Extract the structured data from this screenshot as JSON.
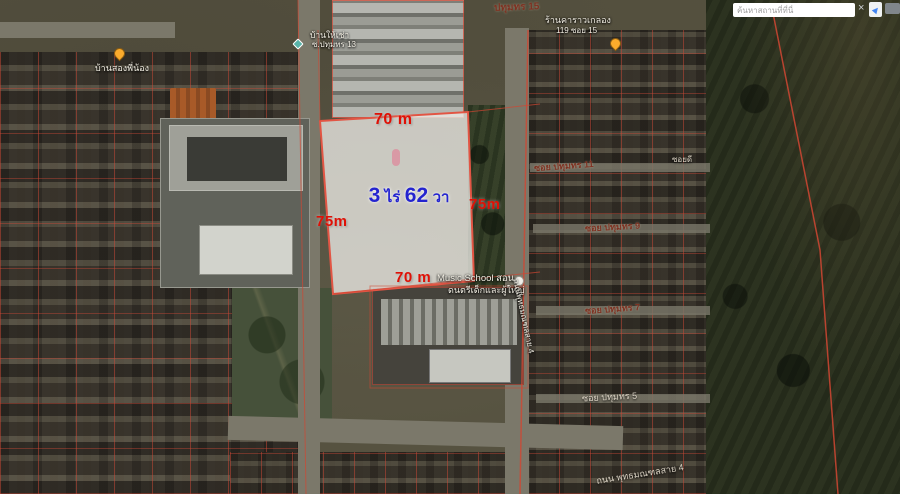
{
  "search": {
    "placeholder": "ค้นหาสถานที่ที่นี่",
    "clear": "×"
  },
  "plot": {
    "dim_top": "70 m",
    "dim_left": "75m",
    "dim_right": "75m",
    "dim_bottom": "70 m",
    "area_num1": "3",
    "area_unit1": "ไร่",
    "area_num2": "62",
    "area_unit2": "วา"
  },
  "places": {
    "house_left": "บ้านสองพี่น้อง",
    "rental_line1": "บ้านให้เช่า",
    "rental_line2": "ซ.ปทุมทร 13",
    "shop_line1": "ร้านคาราวเกลอง",
    "shop_line2": "119 ซอย 15",
    "music_line1": "Music School สอน",
    "music_line2": "ดนตรีเด็กและผู้ใหญ่"
  },
  "streets": {
    "pathumthon15": "ปทุมทร 15",
    "soi11": "ซอย ปทุมทร 11",
    "soi9": "ซอย ปทุมทร 9",
    "soi7": "ซอย ปทุมทร 7",
    "soi5": "ซอย ปทุมทร 5",
    "soidee": "ซอยดี",
    "road_vertical": "ถนนพุทธมณฑลสาย 4",
    "road_bottom": "ถนน พุทธมณฑลสาย 4"
  },
  "colors": {
    "dimension_text": "#e01005",
    "area_text": "#2424cf",
    "parcel_line": "#d24a38",
    "plot_fill": "rgba(236,234,229,0.78)"
  }
}
